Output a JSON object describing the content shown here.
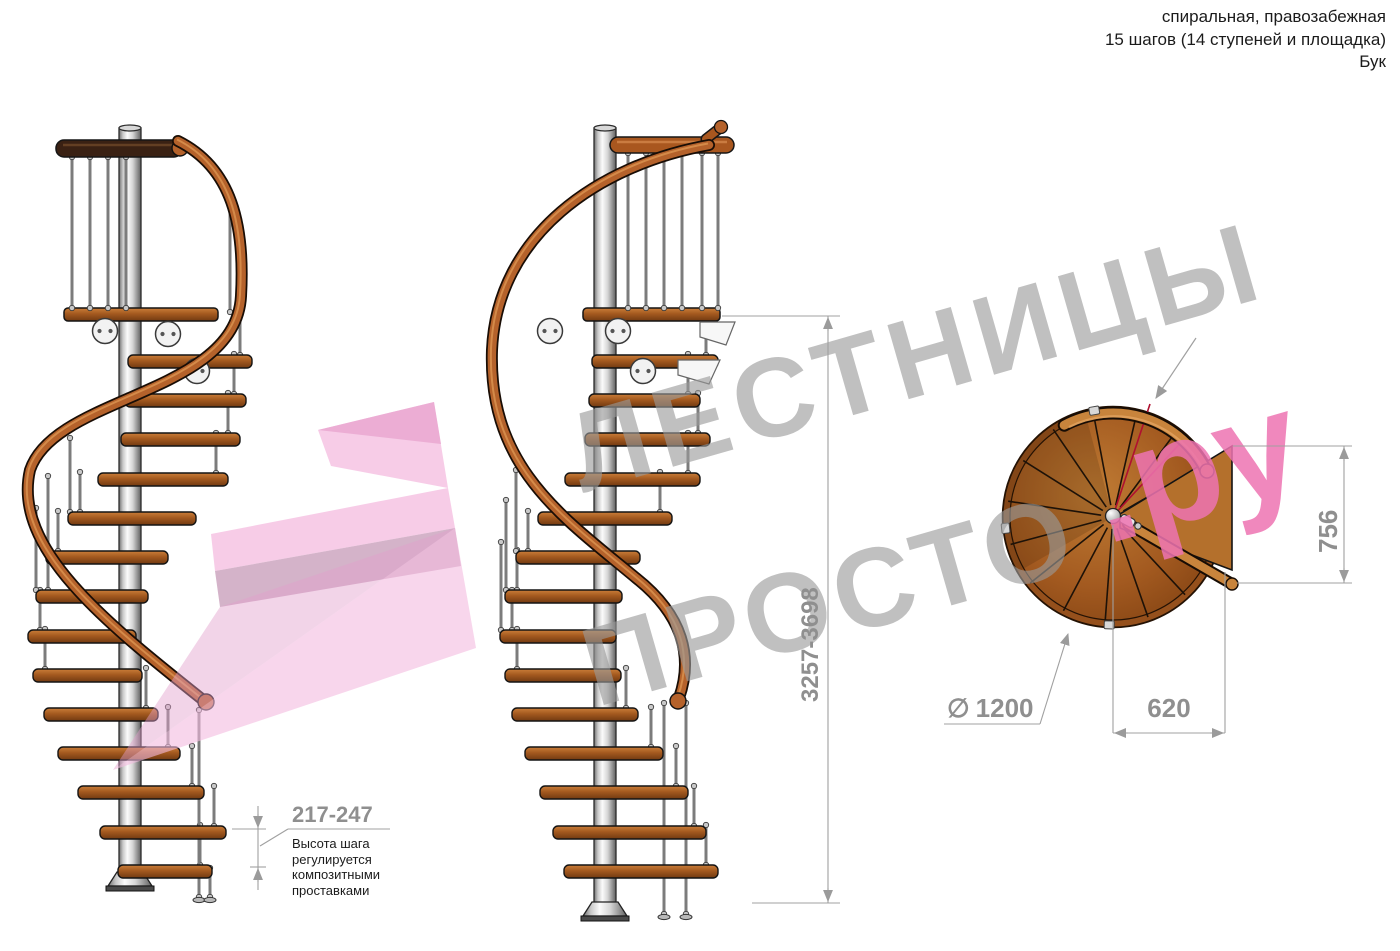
{
  "header": {
    "line1": "спиральная, правозабежная",
    "line2": "15 шагов (14 ступеней и площадка)",
    "line3": "Бук"
  },
  "watermark": {
    "word_top": "ЛЕСТНИЦЫ",
    "word_bottom": "ПРОСТО",
    "suffix": ".ру"
  },
  "dimensions": {
    "total_height": "3257-3698",
    "landing_depth": "756",
    "step_width": "620",
    "diameter_symbol": "∅",
    "diameter_value": "1200",
    "step_rise": "217-247",
    "step_rise_note": "Высота шага\nрегулируется\nкомпозитными\nпроставками"
  },
  "colors": {
    "watermark_gray": "#9a9a9a",
    "watermark_pink": "#ee74b2",
    "dimension_gray": "#8f8f8f",
    "wood": "#a3591f",
    "arrow_pink": "#f3bbdf"
  }
}
